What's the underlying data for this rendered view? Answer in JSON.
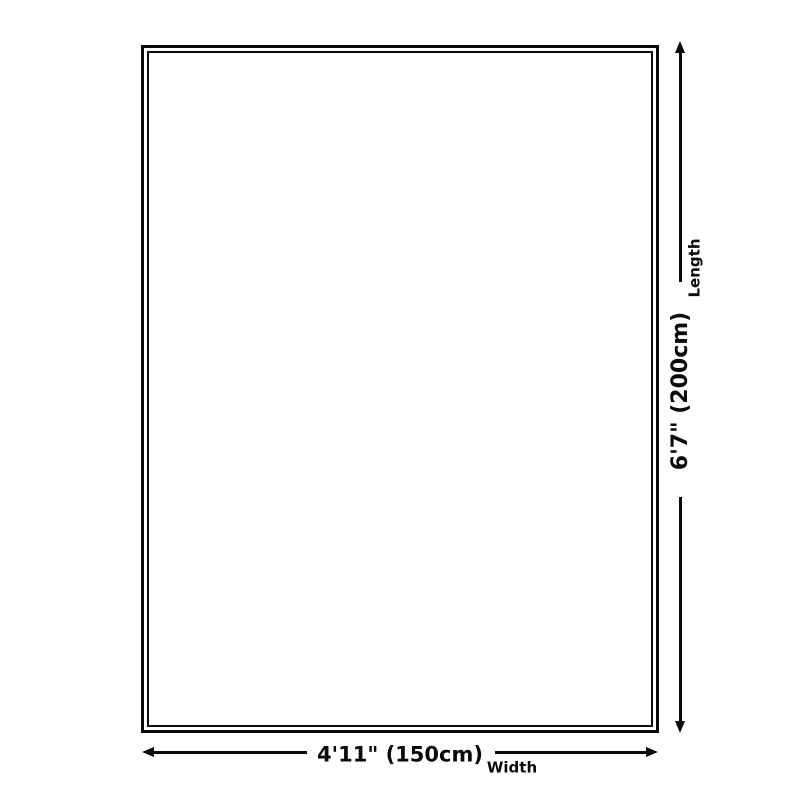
{
  "diagram": {
    "background_color": "#ffffff",
    "line_color": "#0a0a0a",
    "width_dimension": {
      "value": "4'11\" (150cm)",
      "label": "Width"
    },
    "length_dimension": {
      "value": "6'7\" (200cm)",
      "label": "Length"
    }
  }
}
